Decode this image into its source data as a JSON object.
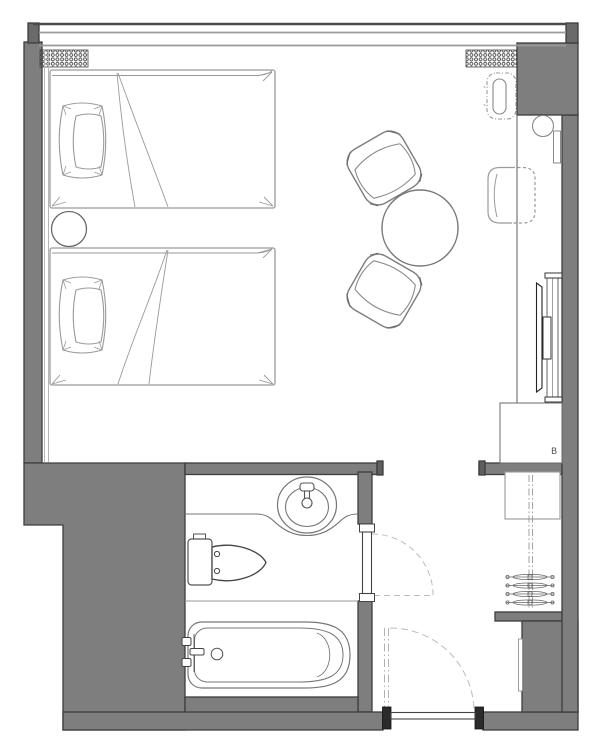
{
  "title": "Hotel guest room floor plan",
  "labels": {
    "minibar_badge": "B"
  },
  "colors": {
    "background": "#ffffff",
    "wall_fill": "#7e7e7e",
    "wall_outline": "#3d3d3d",
    "jamb_fill": "#2b2b2b",
    "furniture_light": "#9a9a9a",
    "furniture_mid": "#777777",
    "fixture_dark": "#4a4a4a",
    "swing_dash": "#bcbcbc",
    "vent_dot": "#333333"
  },
  "rooms": [
    {
      "name": "bedroom"
    },
    {
      "name": "bathroom"
    },
    {
      "name": "entry-hall"
    },
    {
      "name": "closet-niche"
    }
  ],
  "furniture": [
    {
      "name": "bed-1",
      "desc": "single bed with pillow, top-left"
    },
    {
      "name": "bed-2",
      "desc": "single bed with pillow, below bed 1"
    },
    {
      "name": "nightstand",
      "desc": "round table between beds"
    },
    {
      "name": "lounge-chair-upper",
      "desc": "armchair angled toward round table"
    },
    {
      "name": "lounge-chair-lower",
      "desc": "armchair angled toward round table"
    },
    {
      "name": "round-table",
      "desc": "circular coffee table"
    },
    {
      "name": "desk-console",
      "desc": "long desk along right wall"
    },
    {
      "name": "desk-chair",
      "desc": "chair tucked under desk"
    },
    {
      "name": "desk-lamp",
      "desc": "round lamp on desk"
    },
    {
      "name": "wall-panel",
      "desc": "small panel on right wall"
    },
    {
      "name": "tv",
      "desc": "wall-mounted television on bracket"
    },
    {
      "name": "minibar-cabinet",
      "desc": "cabinet below desk"
    },
    {
      "name": "luggage-rack",
      "desc": "folding luggage rack near window"
    },
    {
      "name": "wardrobe",
      "desc": "closet shelf with rod"
    },
    {
      "name": "hangers",
      "desc": "four clothes hangers on rod"
    },
    {
      "name": "sink-vanity",
      "desc": "oval basin with faucet on counter"
    },
    {
      "name": "toilet",
      "desc": "toilet with tank, facing right"
    },
    {
      "name": "bathtub",
      "desc": "bathtub with faucet and drain"
    },
    {
      "name": "bathroom-door",
      "desc": "swing door into entry hall"
    },
    {
      "name": "entry-door",
      "desc": "entry swing door in bottom wall"
    },
    {
      "name": "window-band",
      "desc": "full-width window wall at top"
    },
    {
      "name": "vents",
      "desc": "two perforated grilles under window"
    }
  ]
}
